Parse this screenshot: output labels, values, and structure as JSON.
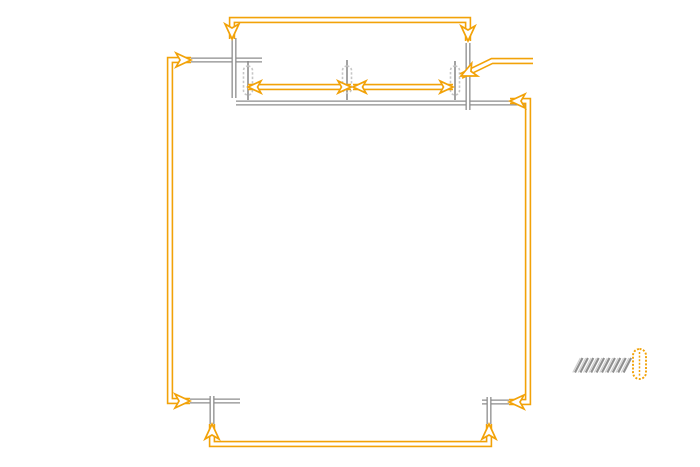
{
  "diagram": {
    "title": "toolpath-direction-diagram",
    "canvas": {
      "width": 700,
      "height": 467,
      "background": "#ffffff"
    },
    "colors": {
      "path_orange": "#F2A208",
      "guide_gray": "#8C8C8C",
      "tool_gray": "#C6C6C6",
      "hatch_gray": "#8F8F8F",
      "hatch_light": "#CFCFCF",
      "background": "#ffffff"
    },
    "stroke": {
      "path_outer": 6.4,
      "path_inner": 3.2,
      "guide_outer": 5.0,
      "guide_inner": 2.4,
      "head_len": 15,
      "head_half_w": 7,
      "head_notch": 11,
      "head_outline": 1.7
    },
    "tool_paths": [
      {
        "name": "toolpath-top-bar",
        "points": [
          [
            232,
            39
          ],
          [
            232,
            20
          ],
          [
            468,
            20
          ],
          [
            468,
            41
          ]
        ],
        "heads": [
          {
            "x": 232,
            "y": 39,
            "a": 90,
            "s": 15
          },
          {
            "x": 468,
            "y": 41,
            "a": 90,
            "s": 15
          }
        ]
      },
      {
        "name": "toolpath-left-bar",
        "points": [
          [
            191,
            60
          ],
          [
            170,
            60
          ],
          [
            170,
            401
          ],
          [
            190,
            401
          ]
        ],
        "heads": [
          {
            "x": 191,
            "y": 60,
            "a": 0,
            "s": 15
          },
          {
            "x": 190,
            "y": 401,
            "a": 0,
            "s": 15
          }
        ]
      },
      {
        "name": "toolpath-right-bar",
        "points": [
          [
            510,
            101
          ],
          [
            528,
            101
          ],
          [
            528,
            402
          ],
          [
            509,
            402
          ]
        ],
        "heads": [
          {
            "x": 510,
            "y": 101,
            "a": 180,
            "s": 15
          },
          {
            "x": 509,
            "y": 402,
            "a": 180,
            "s": 15
          }
        ]
      },
      {
        "name": "toolpath-bottom-bar",
        "points": [
          [
            212,
            424
          ],
          [
            212,
            444
          ],
          [
            489,
            444
          ],
          [
            489,
            424
          ]
        ],
        "heads": [
          {
            "x": 212,
            "y": 424,
            "a": -90,
            "s": 15
          },
          {
            "x": 489,
            "y": 424,
            "a": -90,
            "s": 15
          }
        ]
      },
      {
        "name": "stepover-arrow-left",
        "points": [
          [
            248,
            87
          ],
          [
            351,
            87
          ]
        ],
        "heads": [
          {
            "x": 248,
            "y": 87,
            "a": 180,
            "s": 13
          },
          {
            "x": 351,
            "y": 87,
            "a": 0,
            "s": 13
          }
        ]
      },
      {
        "name": "stepover-arrow-right",
        "points": [
          [
            353,
            87
          ],
          [
            453,
            87
          ]
        ],
        "heads": [
          {
            "x": 353,
            "y": 87,
            "a": 180,
            "s": 13
          },
          {
            "x": 453,
            "y": 87,
            "a": 0,
            "s": 13
          }
        ]
      },
      {
        "name": "tool-callout-arrow",
        "points": [
          [
            533,
            61
          ],
          [
            492,
            61
          ],
          [
            461,
            76
          ]
        ],
        "heads": [
          {
            "x": 461,
            "y": 76,
            "a": 155,
            "s": 15
          }
        ]
      }
    ],
    "guide_lines": [
      {
        "name": "guide-top-left-horizontal",
        "points": [
          [
            186,
            60
          ],
          [
            262,
            60
          ]
        ]
      },
      {
        "name": "guide-top-left-vertical",
        "points": [
          [
            234,
            38
          ],
          [
            234,
            98
          ]
        ]
      },
      {
        "name": "guide-top-edge",
        "points": [
          [
            236,
            103
          ],
          [
            528,
            103
          ]
        ]
      },
      {
        "name": "guide-top-right-vertical",
        "points": [
          [
            468,
            43
          ],
          [
            468,
            110
          ]
        ]
      },
      {
        "name": "guide-bottom-left-horizontal",
        "points": [
          [
            186,
            401
          ],
          [
            240,
            401
          ]
        ]
      },
      {
        "name": "guide-bottom-left-vertical",
        "points": [
          [
            212,
            396
          ],
          [
            212,
            426
          ]
        ]
      },
      {
        "name": "guide-bottom-right-horizontal",
        "points": [
          [
            482,
            402
          ],
          [
            516,
            402
          ]
        ]
      },
      {
        "name": "guide-bottom-right-vertical",
        "points": [
          [
            489,
            397
          ],
          [
            489,
            427
          ]
        ]
      }
    ],
    "tool_positions": [
      {
        "name": "tool-position-1",
        "cx": 248,
        "cap_top": 66,
        "cap_h": 29,
        "cap_w": 9,
        "line_top": 61,
        "line_bottom": 100
      },
      {
        "name": "tool-position-2",
        "cx": 347,
        "cap_top": 66,
        "cap_h": 27,
        "cap_w": 9,
        "line_top": 60,
        "line_bottom": 100
      },
      {
        "name": "tool-position-3",
        "cx": 455,
        "cap_top": 66,
        "cap_h": 29,
        "cap_w": 9,
        "line_top": 61,
        "line_bottom": 100
      }
    ],
    "legend": {
      "hatch": {
        "name": "material-hatching",
        "x_start": 575,
        "y_bottom": 372.5,
        "count": 10,
        "step": 5.4,
        "dx": 7.5,
        "dy": -14.5
      },
      "tool_icon": {
        "name": "legend-tool-capsule",
        "cx": 639.5,
        "cy": 364,
        "w": 13,
        "h": 30
      }
    }
  }
}
